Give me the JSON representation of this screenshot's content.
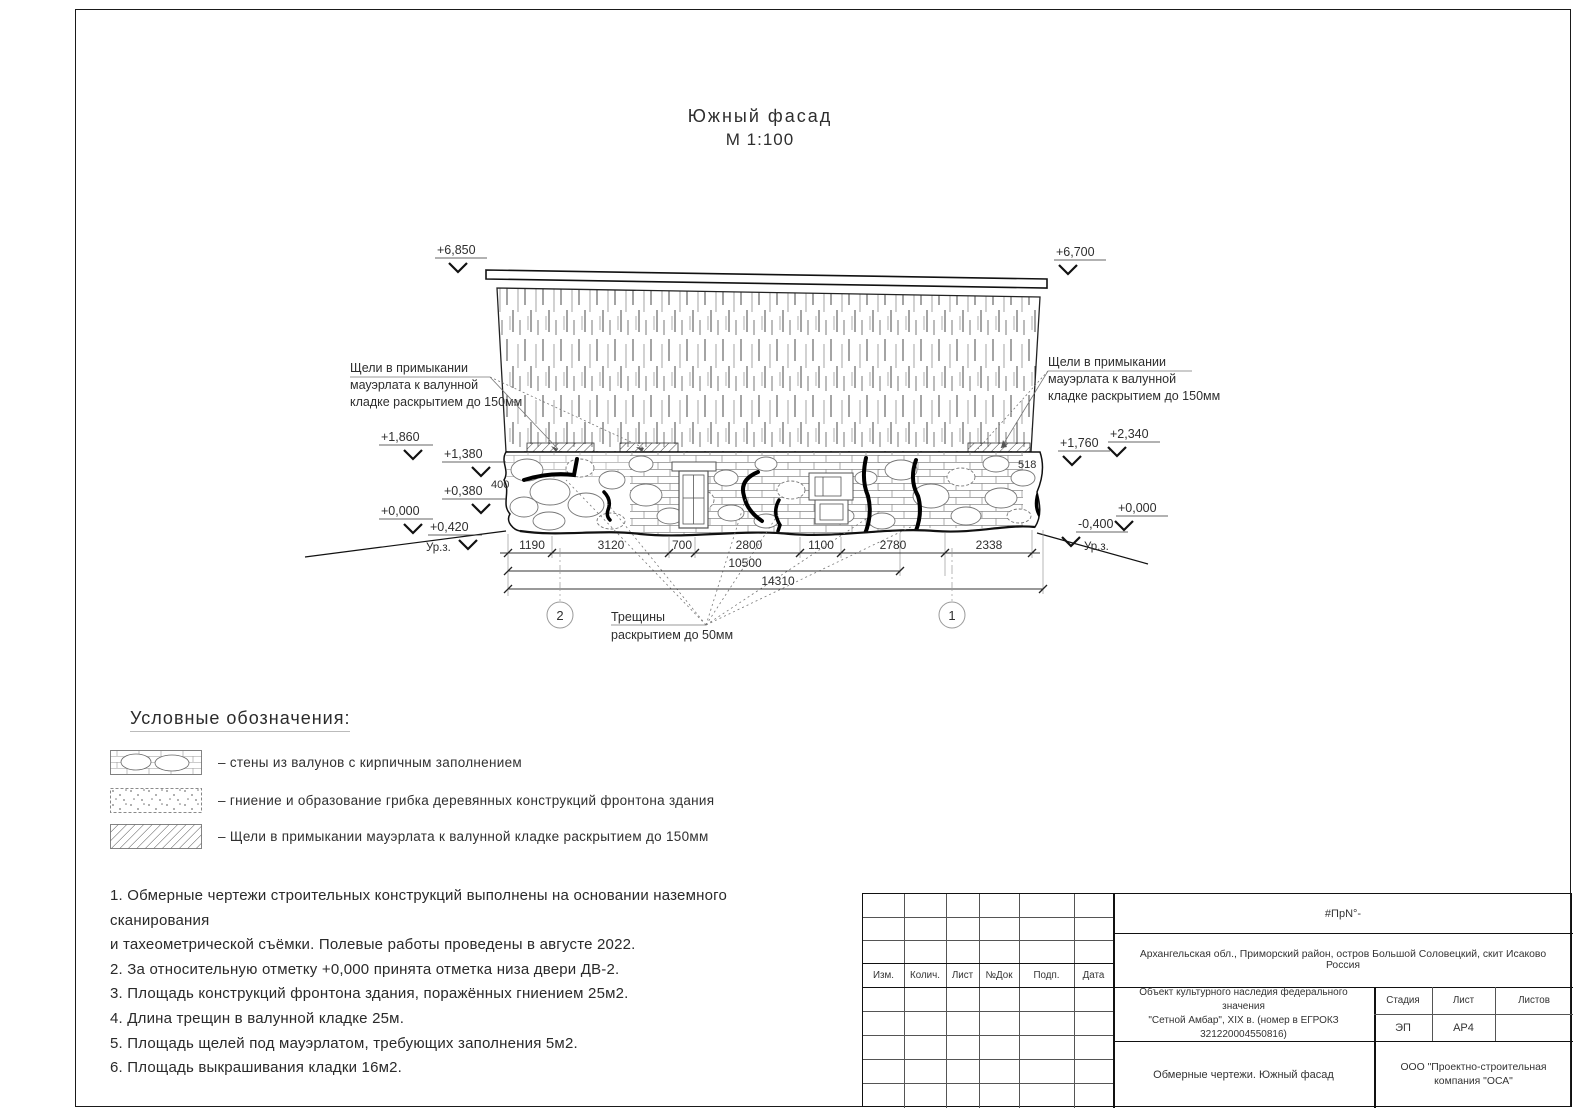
{
  "sheet": {
    "title": "Южный фасад",
    "scale": "М 1:100"
  },
  "facade": {
    "annotation_left": {
      "line1": "Щели в примыкании",
      "line2": "мауэрлата к валунной",
      "line3": "кладке раскрытием до 150мм"
    },
    "annotation_right": {
      "line1": "Щели в примыкании",
      "line2": "мауэрлата к валунной",
      "line3": "кладке раскрытием до 150мм"
    },
    "annotation_cracks": {
      "line1": "Трещины",
      "line2": "раскрытием до 50мм"
    },
    "elev": {
      "l1": "+6,850",
      "l2": "+1,860",
      "l3": "+1,380",
      "l4": "+0,380",
      "l5": "+0,000",
      "l6": "+0,420",
      "r1": "+6,700",
      "r2": "+2,340",
      "r3": "+1,760",
      "r4": "+0,000",
      "r5": "-0,400",
      "ground_left": "Ур.з.",
      "ground_right": "Ур.з."
    },
    "wall_dim_left": "400",
    "wall_dim_right": "518",
    "dims_row1": [
      "1190",
      "3120",
      "700",
      "2800",
      "1100",
      "2780",
      "2338"
    ],
    "dim_total_1": "10500",
    "dim_total_2": "14310",
    "axis_left": "2",
    "axis_right": "1"
  },
  "legend": {
    "title": "Условные обозначения:",
    "items": [
      {
        "label": "–  стены из валунов с кирпичным заполнением"
      },
      {
        "label": "–  гниение и образование грибка деревянных конструкций фронтона здания"
      },
      {
        "label": "–  Щели в примыкании мауэрлата к валунной кладке раскрытием до 150мм"
      }
    ]
  },
  "notes": {
    "lines": [
      "1.  Обмерные чертежи строительных конструкций выполнены на основании наземного сканирования",
      "и тахеометрической съёмки. Полевые работы проведены в августе 2022.",
      "2. За относительную отметку +0,000 принята отметка низа двери ДВ-2.",
      "3. Площадь конструкций фронтона здания, поражённых гниением 25м2.",
      "4. Длина трещин в валунной кладке 25м.",
      "5. Площадь щелей под мауэрлатом, требующих заполнения 5м2.",
      "6. Площадь выкрашивания кладки 16м2."
    ]
  },
  "stamp": {
    "doc_code": "#ПрN°-",
    "address": "Архангельская обл., Приморский район, остров Большой Соловецкий, скит Исаково Россия",
    "object_line1": "Объект культурного наследия федерального значения",
    "object_line2": "\"Сетной Амбар\", XIX в. (номер в ЕГРОКЗ 321220004550816)",
    "rev_headers": [
      "Изм.",
      "Колич.",
      "Лист",
      "№Док",
      "Подп.",
      "Дата"
    ],
    "stage_headers": [
      "Стадия",
      "Лист",
      "Листов"
    ],
    "stage": "ЭП",
    "sheet_no": "АР4",
    "sheets_total": "",
    "drawing_title": "Обмерные чертежи. Южный фасад",
    "company": "ООО \"Проектно-строительная компания \"ОСА\""
  }
}
